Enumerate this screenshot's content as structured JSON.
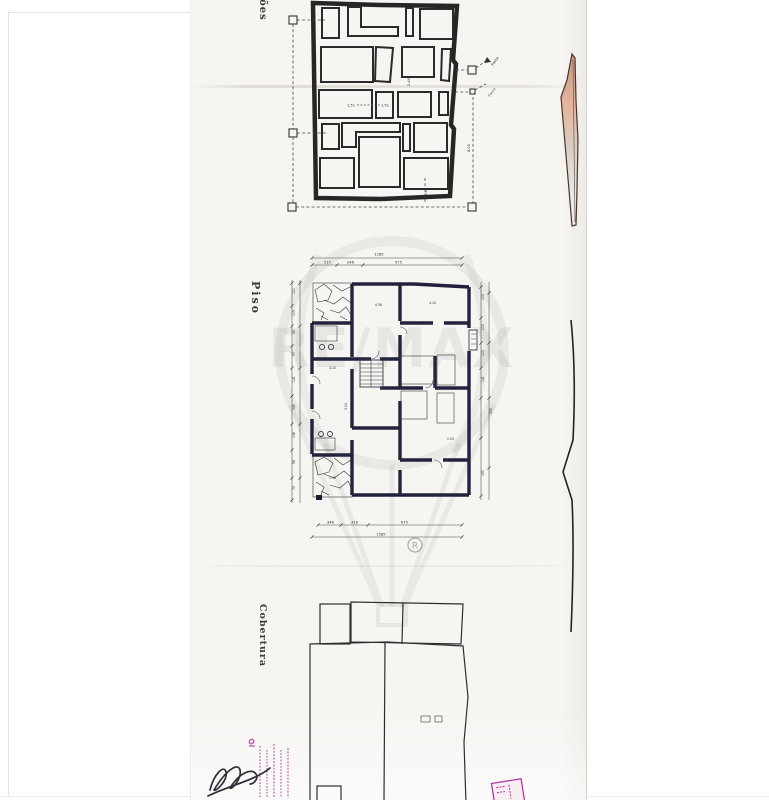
{
  "page": {
    "background": "#ffffff",
    "paper_color": "#f6f5f2"
  },
  "labels": {
    "top_plan": "ções",
    "middle_plan": "Piso",
    "bottom_plan": "Cobertura"
  },
  "foundation_plan": {
    "annotation_fossa": "Fossa",
    "annotation_fossa2": "Fossa",
    "dim_vertical": "8.00",
    "dim_pair_left": "1.51",
    "dim_pair_right": "1.51",
    "dim_small_top": "2.40",
    "dim_small_bottom": "2.40"
  },
  "floor_plan": {
    "dim_top_total": "1185",
    "dims_top": [
      "215",
      "246",
      "575"
    ],
    "dims_bottom": [
      "348",
      "328",
      "875"
    ],
    "dim_bottom_total": "1585",
    "dims_left": [
      "122",
      "113",
      "45",
      "97",
      "141",
      "240",
      "156",
      "98",
      "75"
    ],
    "dims_right": [
      "105",
      "115",
      "123",
      "141",
      "595",
      "163"
    ],
    "room_dims": [
      "4.10",
      "4.58",
      "4.10",
      "1.98",
      "3.04",
      "2.03"
    ]
  },
  "watermark": {
    "brand": "RE/MAX",
    "registered": "R"
  },
  "stamp": {
    "color": "#b5399f"
  }
}
